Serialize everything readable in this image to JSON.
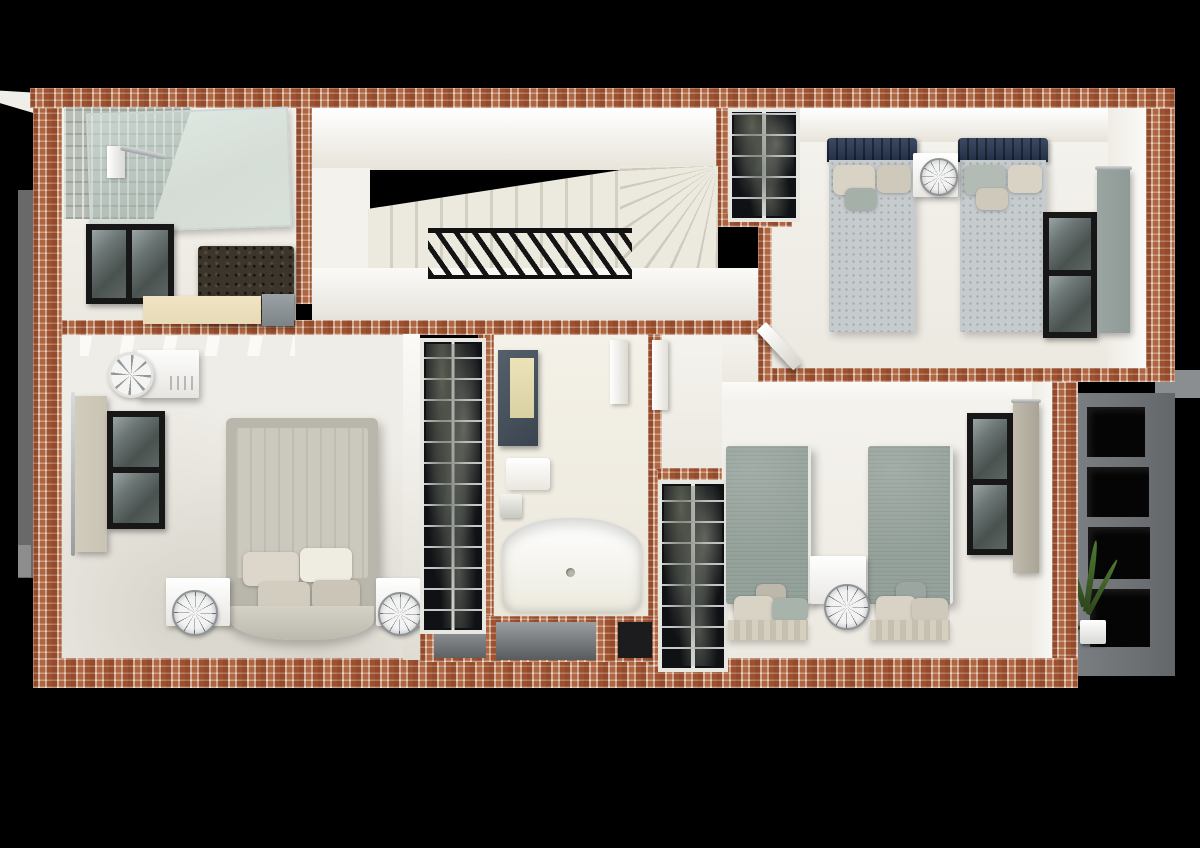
{
  "scene": {
    "description": "3D top-down dollhouse render of an apartment upper floor on a black backdrop",
    "view": "top-down cutaway",
    "rooms": [
      {
        "name": "ensuite-bathroom",
        "position": "top-left",
        "furniture": [
          "walk-in-shower-glass",
          "textured-tile-wall",
          "shower-column",
          "window",
          "dark-fur-rug",
          "vanity-counter",
          "gray-cabinet"
        ]
      },
      {
        "name": "stair-hall",
        "position": "top-center",
        "furniture": [
          "straight-stair-flight",
          "winder-steps",
          "black-slat-railing"
        ]
      },
      {
        "name": "linen-closet-top",
        "position": "top-center-right",
        "furniture": [
          "shelving-unit-with-clothes"
        ]
      },
      {
        "name": "twin-bedroom-top-right",
        "position": "top-right",
        "furniture": [
          "single-bed-navy",
          "single-bed-navy",
          "nightstand",
          "wire-globe-lamp",
          "window",
          "gray-curtain",
          "open-door"
        ]
      },
      {
        "name": "master-bedroom",
        "position": "center-left",
        "furniture": [
          "double-bed-greige",
          "pillows",
          "nightstand-left",
          "nightstand-right",
          "wire-globe-lamp",
          "wire-globe-lamp",
          "ac-unit",
          "ceiling-fan",
          "window",
          "beige-curtain",
          "ceiling-beams"
        ]
      },
      {
        "name": "walk-in-closet",
        "position": "center",
        "furniture": [
          "tall-shelving-unit-with-clothes"
        ]
      },
      {
        "name": "family-bathroom",
        "position": "center",
        "furniture": [
          "mirror-cabinet",
          "toilet",
          "faucet-fixture",
          "bathtub",
          "towel-rail"
        ]
      },
      {
        "name": "hall-closet-lower",
        "position": "center-right",
        "furniture": [
          "shelving-unit-with-clothes",
          "white-door-panel"
        ]
      },
      {
        "name": "twin-bedroom-right",
        "position": "right",
        "furniture": [
          "single-bed-sage",
          "single-bed-sage",
          "nightstand",
          "wire-globe-lamp",
          "window",
          "beige-curtain"
        ]
      },
      {
        "name": "exterior-facade",
        "position": "bottom-right",
        "furniture": [
          "gray-niche-shelf-grid",
          "potted-plant"
        ]
      },
      {
        "name": "exterior-niches-bottom",
        "position": "bottom-center",
        "furniture": [
          "recessed-wall-niches"
        ]
      }
    ]
  },
  "palette": {
    "background": "#000000",
    "brick_base": "#a35a38",
    "floor_light": "#ece9e1",
    "floor_cream": "#eae6d9",
    "stair_tread": "#eceadf",
    "railing_black": "#141414",
    "window_frame": "#171717",
    "shower_tile": "#b9beb6",
    "rug_brown": "#3c352b",
    "vanity_beige": "#e8dab6",
    "navy_headboard": "#232f45",
    "mattress_gray": "#c6cbcd",
    "sage_bed": "#95a19b",
    "greige_bed": "#cbc8be",
    "pillow_beige": "#d9d3c6",
    "curtain_gray": "#8f9a97",
    "curtain_beige": "#c9c3b3",
    "closet_dark": "#101114",
    "exterior_gray": "#63676a",
    "niche_black": "#050505",
    "plant_green": "#4e7a33",
    "side_strip_gray": "#696969"
  }
}
